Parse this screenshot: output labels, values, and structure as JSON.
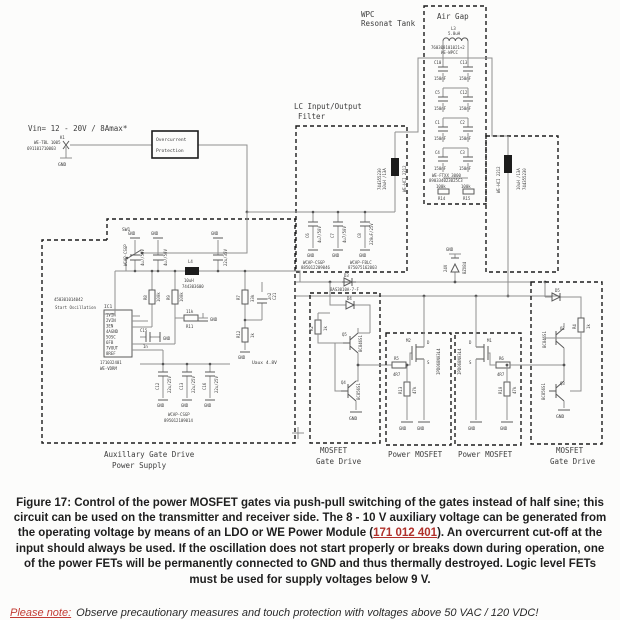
{
  "caption": {
    "part1": "Figure 17: Control of the power MOSFET gates via push-pull switching of the gates instead of half sine; this circuit can be used on the transmitter and receiver side. The 8 - 10 V auxiliary voltage can be generated from the operating voltage by means of an LDO or WE Power Module (",
    "link": "171 012 401",
    "part2": "). An overcurrent cut-off at the input should always be used. If the oscillation does not start properly or breaks down during operation, one of the power FETs will be permanently connected to GND and thus thermally destroyed. Logic level FETs must be used for supply voltages below 9 V."
  },
  "note": {
    "label": "Please note:",
    "text": "Observe precautionary measures and touch protection with voltages above 50 VAC / 120 VDC!"
  },
  "sch": {
    "gnd": "GND",
    "input": {
      "vin": "Vin= 12 - 20V / 8Amax*",
      "k": "K1",
      "series": "WE-TBL 1005",
      "part": "691101710003"
    },
    "ocp": {
      "l1": "Overcurrent",
      "l2": "Protection"
    },
    "tank": {
      "t1": "WPC",
      "t2": "Resonat Tank",
      "airgap": "Air Gap",
      "l3": "L3",
      "l3v": "5.0uH",
      "l3p": "760308101021+2",
      "l3s": "WE-WPCC",
      "capv": "150nF",
      "cl": [
        "C10",
        "C5",
        "C1",
        "C4"
      ],
      "cr": [
        "C13",
        "C12",
        "C2",
        "C3"
      ],
      "cs": "WE-FTXX 3000",
      "cp": "890334023025C3",
      "r14": "R14",
      "r15": "R15",
      "rv": "100k"
    },
    "lc": {
      "t1": "LC Input/Output",
      "t2": "Filter",
      "l1": "L1",
      "l2": "L2",
      "lv": "10uH /13A",
      "lp": "744355230",
      "ls": "WE-HCI 2212",
      "c6": "C6",
      "c6v": "4u7/50V",
      "c7": "C7",
      "c7v": "4u7/50V",
      "c8": "C8",
      "c8v": "220uF/25V",
      "cs1": "WCAP-CSGP",
      "cp1": "885012209046",
      "cs2": "WCAP-FBLC",
      "cp2": "875075162003",
      "dzv": "24V",
      "dzp": "BZX84",
      "d3": "D3",
      "d3p": "BAS3010A-7-F"
    },
    "aux": {
      "t1": "Auxillary Gate Drive",
      "t2": "Power Supply",
      "sw": "SW1",
      "swp": "450301014042",
      "swl": "Start Oscillation",
      "ic": "IC1",
      "icp": "171032401",
      "ics": "WE-VDRM",
      "pins": [
        "1VIN",
        "2VIN",
        "3EN",
        "4AGND",
        "5OSC",
        "6FB",
        "7VOUT",
        "8REF"
      ],
      "l4": "L4",
      "l4v": "10uH",
      "l4p": "744303600",
      "c9v": "4u7/50V",
      "c10v": "4u7/50V",
      "c11v": "22u/35V",
      "cts": "WCAP-CSGP",
      "r8": "R8",
      "r9": "R9",
      "r89v": "100k",
      "r11": "R11",
      "r11v": "11k",
      "c15": "C15",
      "c15v": "1n",
      "r7": "R7",
      "r7v": "33k",
      "r12": "R12",
      "r12v": "1k",
      "c21": "C21",
      "c21v": "2n2",
      "uaux": "Uaux 4.8V",
      "cb": [
        "C12",
        "C13",
        "C16"
      ],
      "cbv": "22u/25V",
      "cbs": "WCAP-CSGP",
      "cbp": "895012109014"
    },
    "gdl": {
      "t1": "MOSFET",
      "t2": "Gate Drive",
      "d4": "D4",
      "r2": "R2",
      "r2v": "1k",
      "q5": "Q5",
      "q5p": "BC846S1",
      "q4": "Q4",
      "q4p": "BC856S1"
    },
    "pm1": {
      "t": "Power MOSFET",
      "m": "M2",
      "mp": "IPD068N03L4",
      "d": "D",
      "s": "S",
      "r5": "R5",
      "r5v": "4R7",
      "r13": "R13",
      "r13v": "47k"
    },
    "pm2": {
      "t": "Power MOSFET",
      "m": "M1",
      "mp": "IPD068N03L4",
      "d": "D",
      "s": "S",
      "r6": "R6",
      "r6v": "4R7",
      "r10": "R10",
      "r10v": "47k"
    },
    "gdr": {
      "t1": "MOSFET",
      "t2": "Gate Drive",
      "d5": "D5",
      "r4": "R4",
      "r4v": "1k",
      "q2": "Q2",
      "q2p": "BC846S1",
      "q3": "Q3",
      "q3p": "BC856S1"
    }
  }
}
